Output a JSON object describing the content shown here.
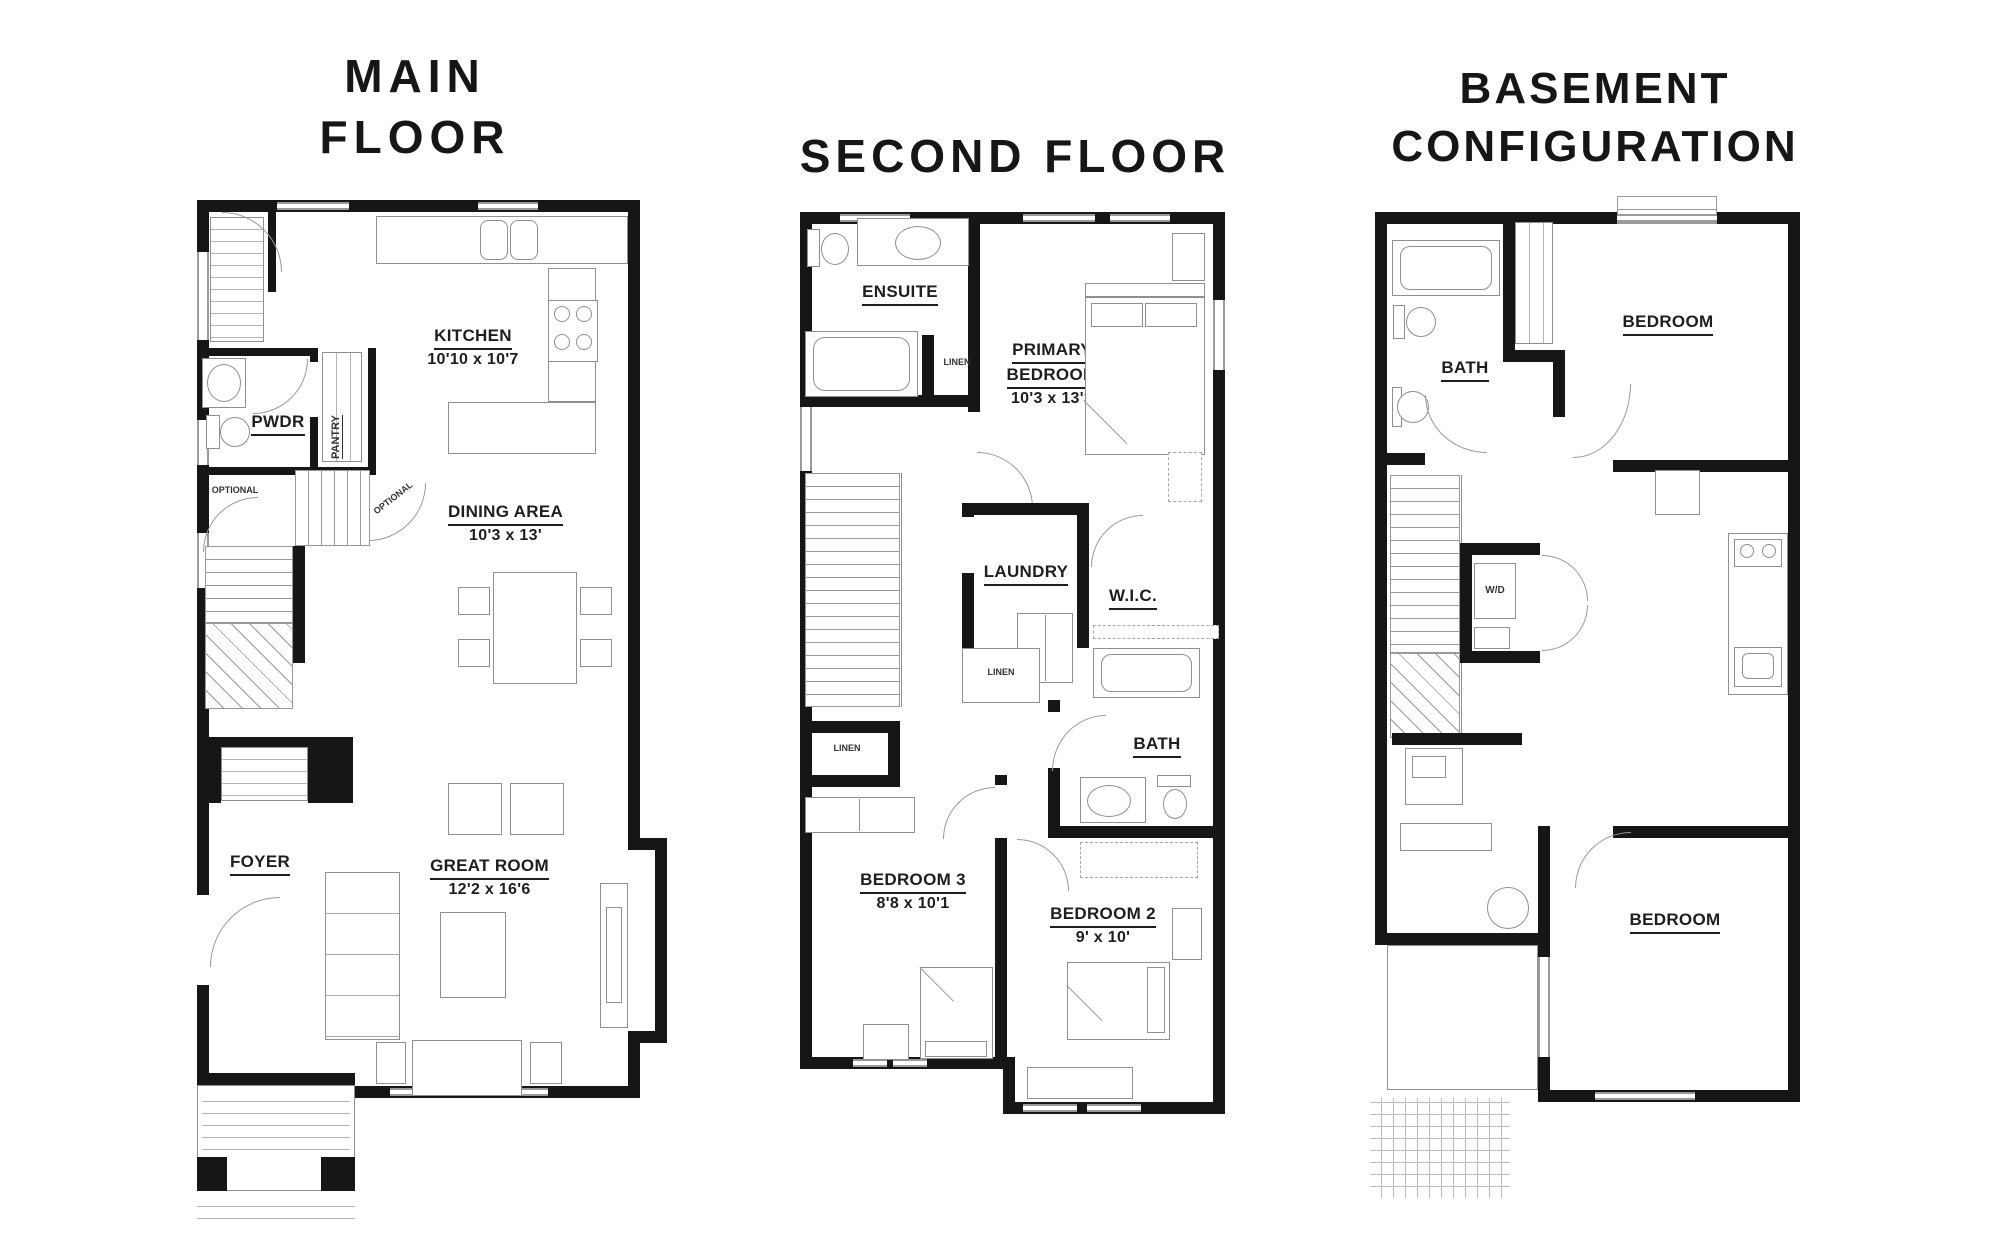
{
  "titles": {
    "main_line1": "MAIN",
    "main_line2": "FLOOR",
    "second": "SECOND FLOOR",
    "basement_line1": "BASEMENT",
    "basement_line2": "CONFIGURATION"
  },
  "main": {
    "kitchen_name": "KITCHEN",
    "kitchen_dims": "10'10 x 10'7",
    "pwdr": "PWDR",
    "pantry": "PANTRY",
    "optional_left": "OPTIONAL",
    "optional_stairs": "OPTIONAL",
    "dining_name": "DINING AREA",
    "dining_dims": "10'3 x 13'",
    "foyer": "FOYER",
    "great_name": "GREAT ROOM",
    "great_dims": "12'2 x 16'6"
  },
  "second": {
    "ensuite": "ENSUITE",
    "linen_top": "LINEN",
    "primary_line1": "PRIMARY",
    "primary_line2": "BEDROOM",
    "primary_dims": "10'3 x 13'3",
    "laundry": "LAUNDRY",
    "wic": "W.I.C.",
    "linen_mid": "LINEN",
    "linen_left": "LINEN",
    "bedroom3_name": "BEDROOM 3",
    "bedroom3_dims": "8'8 x 10'1",
    "bath": "BATH",
    "bedroom2_name": "BEDROOM 2",
    "bedroom2_dims": "9' x 10'"
  },
  "basement": {
    "bath": "BATH",
    "bedroom_top": "BEDROOM",
    "wd": "W/D",
    "bedroom_bottom": "BEDROOM"
  }
}
